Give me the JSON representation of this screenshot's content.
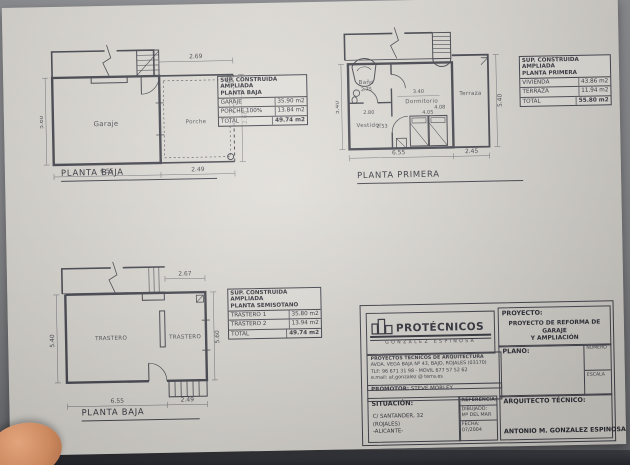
{
  "photo": {
    "desk_color": "#8f9094",
    "band_color": "#2b2c33",
    "paper_color": "#ebe8e2",
    "ink_color": "#4e4f58"
  },
  "plans": {
    "baja": {
      "title": "PLANTA BAJA",
      "room_garaje": "Garaje",
      "room_porche": "Porche",
      "dim_left": "5.60",
      "dim_bottom_main": "6.55",
      "dim_bottom_porche": "2.49",
      "dim_top_porche": "2.69",
      "dim_right": "2.68",
      "table": {
        "header1": "SUP. CONSTRUIDA AMPLIADA",
        "header2": "PLANTA BAJA",
        "rows": [
          [
            "GARAJE",
            "35.90 m2"
          ],
          [
            "PORCHE 100%",
            "13.84 m2"
          ],
          [
            "TOTAL",
            "49.74 m2"
          ]
        ]
      }
    },
    "primera": {
      "title": "PLANTA PRIMERA",
      "room_bano": "Baño",
      "room_vestidor": "Vestidor",
      "room_dormitorio": "Dormitorio",
      "room_terraza": "Terraza",
      "dim_left": "5.40",
      "dim_right": "5.40",
      "dim_bottom_main": "6.55",
      "dim_bottom_terraza": "2.45",
      "dim_340": "3.40",
      "dim_408": "4.08",
      "dim_405": "4.05",
      "dim_280": "2.80",
      "dim_253": "2.53",
      "dim_275": "2.75",
      "table": {
        "header1": "SUP. CONSTRUIDA AMPLIADA",
        "header2": "PLANTA PRIMERA",
        "rows": [
          [
            "VIVIENDA",
            "43.86 m2"
          ],
          [
            "TERRAZA",
            "11.94 m2"
          ],
          [
            "TOTAL",
            "55.80 m2"
          ]
        ]
      }
    },
    "semisotano": {
      "title": "PLANTA BAJA",
      "room_trastero1": "TRASTERO",
      "room_trastero2": "TRASTERO",
      "dim_left": "5.40",
      "dim_right": "5.60",
      "dim_top": "2.67",
      "dim_bottom_main": "6.55",
      "dim_bottom_stair": "2.49",
      "table": {
        "header1": "SUP. CONSTRUIDA AMPLIADA",
        "header2": "PLANTA SEMISOTANO",
        "rows": [
          [
            "TRASTERO 1",
            "35.80 m2"
          ],
          [
            "TRASTERO 2",
            "13.94 m2"
          ],
          [
            "TOTAL",
            "49.74 m2"
          ]
        ]
      }
    }
  },
  "titleblock": {
    "logo_name": "PROTÉCNICOS",
    "logo_sub": "GONZALEZ ESPINOSA",
    "firm_line1": "PROYECTOS TÉCNICOS DE ARQUITECTURA",
    "firm_line2": "AVDA. VEGA BAJA Nº 43, BAJO, ROJALES (03170)",
    "firm_line3": "TLF: 96 671 31 98 - MOVIL 677 57 52 62",
    "firm_line4": "e.mail: at.gonzalez @ terra.es",
    "promotor_label": "PROMOTOR:",
    "promotor_value": "STEVE MORLEY",
    "proyecto_label": "PROYECTO:",
    "proyecto_line1": "PROYECTO DE REFORMA DE GARAJE",
    "proyecto_line2": "Y AMPLIACIÓN",
    "plano_label": "PLANO:",
    "numero_label": "NUMERO",
    "escala_label": "ESCALA",
    "situacion_label": "SITUACIÓN:",
    "situacion_line1": "C/ SANTANDER, 32",
    "situacion_line2": "(ROJALES)",
    "situacion_line3": "-ALICANTE-",
    "referencia_label": "REFERENCIA:",
    "dibujado_label": "DIBUJADO:",
    "dibujado_value": "Mª DEL MAR",
    "fecha_label": "FECHA:",
    "fecha_value": "07/2004",
    "arquitecto_label": "ARQUITECTO TÉCNICO:",
    "arquitecto_value": "ANTONIO M. GONZALEZ ESPINOSA"
  }
}
